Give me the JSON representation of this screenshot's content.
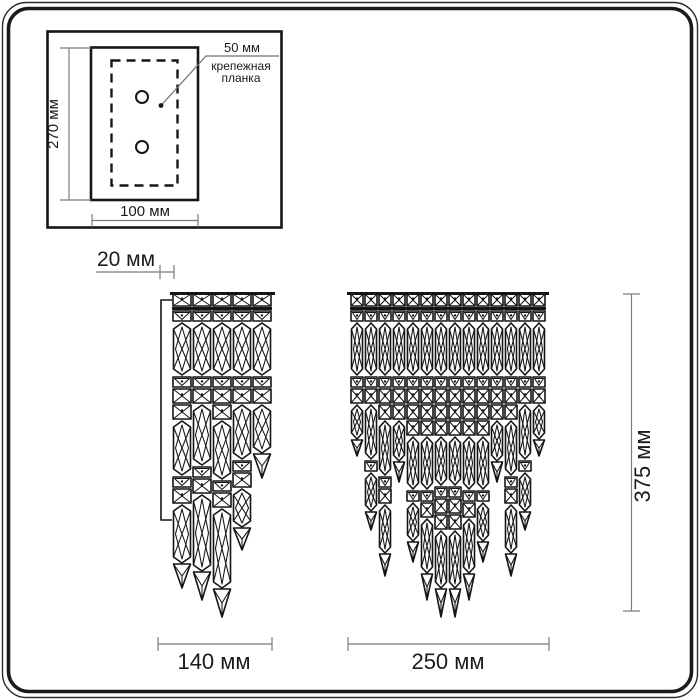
{
  "labels": {
    "plate_height": "270 мм",
    "plate_width": "100 мм",
    "plate_offset": "50 мм",
    "plate_caption_line1": "крепежная",
    "plate_caption_line2": "планка",
    "depth": "20 мм",
    "side_width": "140 мм",
    "front_width": "250 мм",
    "total_height": "375 мм"
  },
  "colors": {
    "drawing_line": "#151515",
    "dimension_line": "#7b7b7b",
    "text": "#1b1b1b",
    "background": "#ffffff"
  },
  "figure": {
    "side_view": {
      "x": 172,
      "y": 293,
      "strand_width": 20,
      "top_bar": {
        "x1": 170,
        "x2": 275,
        "y": 293.5
      },
      "wall_plate": {
        "x": 161,
        "y1": 300,
        "y2": 520,
        "arm": 11
      },
      "strands": [
        [
          [
            "sq",
            14
          ],
          [
            "bar",
            3
          ],
          [
            "bd",
            12
          ],
          [
            "pr",
            54
          ],
          [
            "bd",
            12
          ],
          [
            "sq",
            16
          ],
          [
            "sq",
            16
          ],
          [
            "pr",
            56
          ],
          [
            "bd",
            12
          ],
          [
            "sq",
            16
          ],
          [
            "pr",
            60
          ],
          [
            "tip",
            24
          ]
        ],
        [
          [
            "sq",
            14
          ],
          [
            "bar",
            3
          ],
          [
            "bd",
            12
          ],
          [
            "pr",
            54
          ],
          [
            "bd",
            12
          ],
          [
            "sq",
            16
          ],
          [
            "pr",
            62
          ],
          [
            "bd",
            12
          ],
          [
            "sq",
            16
          ],
          [
            "pr",
            78
          ],
          [
            "tip",
            28
          ]
        ],
        [
          [
            "sq",
            14
          ],
          [
            "bar",
            3
          ],
          [
            "bd",
            12
          ],
          [
            "pr",
            54
          ],
          [
            "bd",
            12
          ],
          [
            "sq",
            16
          ],
          [
            "sq",
            16
          ],
          [
            "pr",
            60
          ],
          [
            "bd",
            12
          ],
          [
            "sq",
            16
          ],
          [
            "pr",
            81
          ],
          [
            "tip",
            28
          ]
        ],
        [
          [
            "sq",
            14
          ],
          [
            "bar",
            3
          ],
          [
            "bd",
            12
          ],
          [
            "pr",
            54
          ],
          [
            "bd",
            12
          ],
          [
            "sq",
            16
          ],
          [
            "pr",
            56
          ],
          [
            "bd",
            12
          ],
          [
            "sq",
            16
          ],
          [
            "pr",
            40
          ],
          [
            "tip",
            22
          ]
        ],
        [
          [
            "sq",
            14
          ],
          [
            "bar",
            3
          ],
          [
            "bd",
            12
          ],
          [
            "pr",
            54
          ],
          [
            "bd",
            12
          ],
          [
            "sq",
            16
          ],
          [
            "pr",
            50
          ],
          [
            "tip",
            24
          ]
        ]
      ]
    },
    "front_view": {
      "x": 350,
      "y": 293,
      "strand_width": 14,
      "top_bar": {
        "x1": 347,
        "x2": 549,
        "y": 293.5
      },
      "strands": [
        [
          [
            "sq",
            14
          ],
          [
            "bar",
            3
          ],
          [
            "bd",
            12
          ],
          [
            "pr",
            54
          ],
          [
            "bd",
            12
          ],
          [
            "sq",
            16
          ],
          [
            "pr",
            36
          ],
          [
            "tip",
            16
          ]
        ],
        [
          [
            "sq",
            14
          ],
          [
            "bar",
            3
          ],
          [
            "bd",
            12
          ],
          [
            "pr",
            54
          ],
          [
            "bd",
            12
          ],
          [
            "sq",
            16
          ],
          [
            "pr",
            56
          ],
          [
            "bd",
            12
          ],
          [
            "pr",
            40
          ],
          [
            "tip",
            18
          ]
        ],
        [
          [
            "sq",
            14
          ],
          [
            "bar",
            3
          ],
          [
            "bd",
            12
          ],
          [
            "pr",
            54
          ],
          [
            "bd",
            12
          ],
          [
            "sq",
            16
          ],
          [
            "sq",
            16
          ],
          [
            "pr",
            56
          ],
          [
            "bd",
            12
          ],
          [
            "sq",
            16
          ],
          [
            "pr",
            50
          ],
          [
            "tip",
            22
          ]
        ],
        [
          [
            "sq",
            14
          ],
          [
            "bar",
            3
          ],
          [
            "bd",
            12
          ],
          [
            "pr",
            54
          ],
          [
            "bd",
            12
          ],
          [
            "sq",
            16
          ],
          [
            "sq",
            16
          ],
          [
            "pr",
            42
          ],
          [
            "tip",
            20
          ]
        ],
        [
          [
            "sq",
            14
          ],
          [
            "bar",
            3
          ],
          [
            "bd",
            12
          ],
          [
            "pr",
            54
          ],
          [
            "bd",
            12
          ],
          [
            "sq",
            16
          ],
          [
            "sq",
            16
          ],
          [
            "sq",
            16
          ],
          [
            "pr",
            54
          ],
          [
            "bd",
            12
          ],
          [
            "pr",
            40
          ],
          [
            "tip",
            20
          ]
        ],
        [
          [
            "sq",
            14
          ],
          [
            "bar",
            3
          ],
          [
            "bd",
            12
          ],
          [
            "pr",
            54
          ],
          [
            "bd",
            12
          ],
          [
            "sq",
            16
          ],
          [
            "sq",
            16
          ],
          [
            "sq",
            16
          ],
          [
            "pr",
            54
          ],
          [
            "bd",
            12
          ],
          [
            "sq",
            16
          ],
          [
            "pr",
            56
          ],
          [
            "tip",
            26
          ]
        ],
        [
          [
            "sq",
            14
          ],
          [
            "bar",
            3
          ],
          [
            "bd",
            12
          ],
          [
            "pr",
            54
          ],
          [
            "bd",
            12
          ],
          [
            "sq",
            16
          ],
          [
            "sq",
            16
          ],
          [
            "sq",
            16
          ],
          [
            "pr",
            50
          ],
          [
            "bd",
            12
          ],
          [
            "sq",
            16
          ],
          [
            "sq",
            16
          ],
          [
            "pr",
            59
          ],
          [
            "tip",
            28
          ]
        ],
        [
          [
            "sq",
            14
          ],
          [
            "bar",
            3
          ],
          [
            "bd",
            12
          ],
          [
            "pr",
            54
          ],
          [
            "bd",
            12
          ],
          [
            "sq",
            16
          ],
          [
            "sq",
            16
          ],
          [
            "sq",
            16
          ],
          [
            "pr",
            50
          ],
          [
            "bd",
            12
          ],
          [
            "sq",
            16
          ],
          [
            "sq",
            16
          ],
          [
            "pr",
            59
          ],
          [
            "tip",
            28
          ]
        ],
        [
          [
            "sq",
            14
          ],
          [
            "bar",
            3
          ],
          [
            "bd",
            12
          ],
          [
            "pr",
            54
          ],
          [
            "bd",
            12
          ],
          [
            "sq",
            16
          ],
          [
            "sq",
            16
          ],
          [
            "sq",
            16
          ],
          [
            "pr",
            54
          ],
          [
            "bd",
            12
          ],
          [
            "sq",
            16
          ],
          [
            "pr",
            56
          ],
          [
            "tip",
            26
          ]
        ],
        [
          [
            "sq",
            14
          ],
          [
            "bar",
            3
          ],
          [
            "bd",
            12
          ],
          [
            "pr",
            54
          ],
          [
            "bd",
            12
          ],
          [
            "sq",
            16
          ],
          [
            "sq",
            16
          ],
          [
            "sq",
            16
          ],
          [
            "pr",
            54
          ],
          [
            "bd",
            12
          ],
          [
            "pr",
            40
          ],
          [
            "tip",
            20
          ]
        ],
        [
          [
            "sq",
            14
          ],
          [
            "bar",
            3
          ],
          [
            "bd",
            12
          ],
          [
            "pr",
            54
          ],
          [
            "bd",
            12
          ],
          [
            "sq",
            16
          ],
          [
            "sq",
            16
          ],
          [
            "pr",
            42
          ],
          [
            "tip",
            20
          ]
        ],
        [
          [
            "sq",
            14
          ],
          [
            "bar",
            3
          ],
          [
            "bd",
            12
          ],
          [
            "pr",
            54
          ],
          [
            "bd",
            12
          ],
          [
            "sq",
            16
          ],
          [
            "sq",
            16
          ],
          [
            "pr",
            56
          ],
          [
            "bd",
            12
          ],
          [
            "sq",
            16
          ],
          [
            "pr",
            50
          ],
          [
            "tip",
            22
          ]
        ],
        [
          [
            "sq",
            14
          ],
          [
            "bar",
            3
          ],
          [
            "bd",
            12
          ],
          [
            "pr",
            54
          ],
          [
            "bd",
            12
          ],
          [
            "sq",
            16
          ],
          [
            "pr",
            56
          ],
          [
            "bd",
            12
          ],
          [
            "pr",
            40
          ],
          [
            "tip",
            18
          ]
        ],
        [
          [
            "sq",
            14
          ],
          [
            "bar",
            3
          ],
          [
            "bd",
            12
          ],
          [
            "pr",
            54
          ],
          [
            "bd",
            12
          ],
          [
            "sq",
            16
          ],
          [
            "pr",
            36
          ],
          [
            "tip",
            16
          ]
        ]
      ]
    }
  }
}
